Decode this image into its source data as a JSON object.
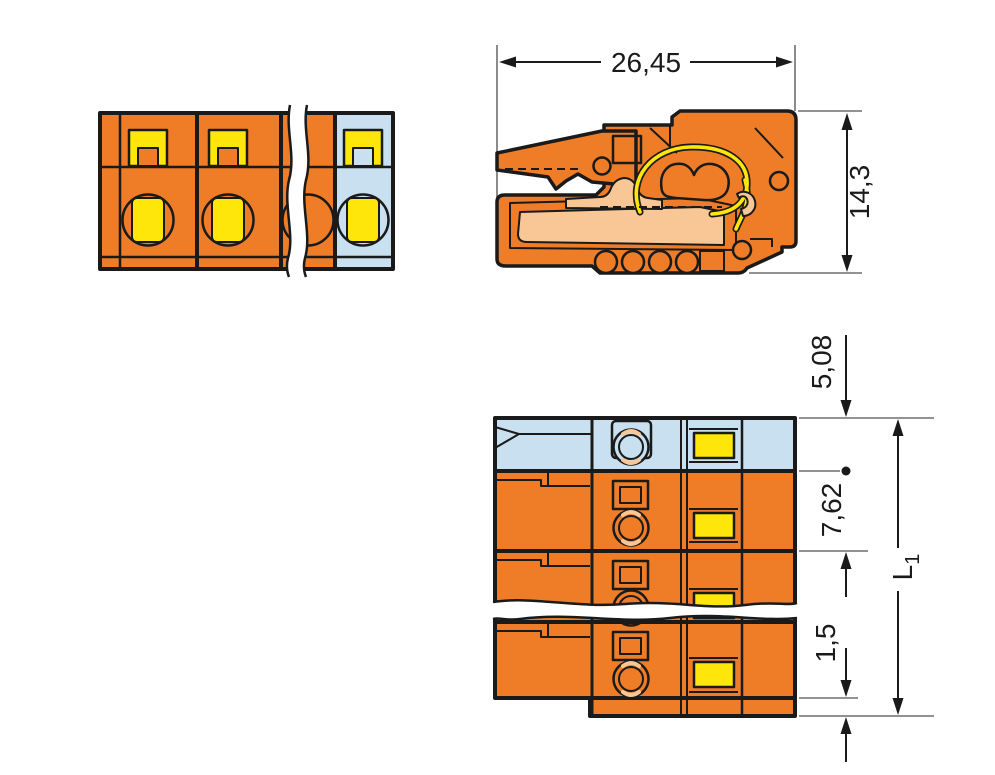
{
  "drawing_type": "connector-dimensional-drawing",
  "dimensions": {
    "overall_width": "26,45",
    "overall_height": "14,3",
    "end_offset": "5,08",
    "pole_pitch": "7,62",
    "step_height": "1,5",
    "total_length_symbol": "L",
    "total_length_subscript": "1"
  },
  "colors": {
    "housing_orange": "#EF7D28",
    "end_pole_blue": "#C8E0F0",
    "marker_yellow": "#FFE60A",
    "contact_peach": "#F8C795",
    "outline_black": "#1A1A1A",
    "ext_line_gray": "#6E6E6E",
    "background_white": "#FFFFFF"
  }
}
